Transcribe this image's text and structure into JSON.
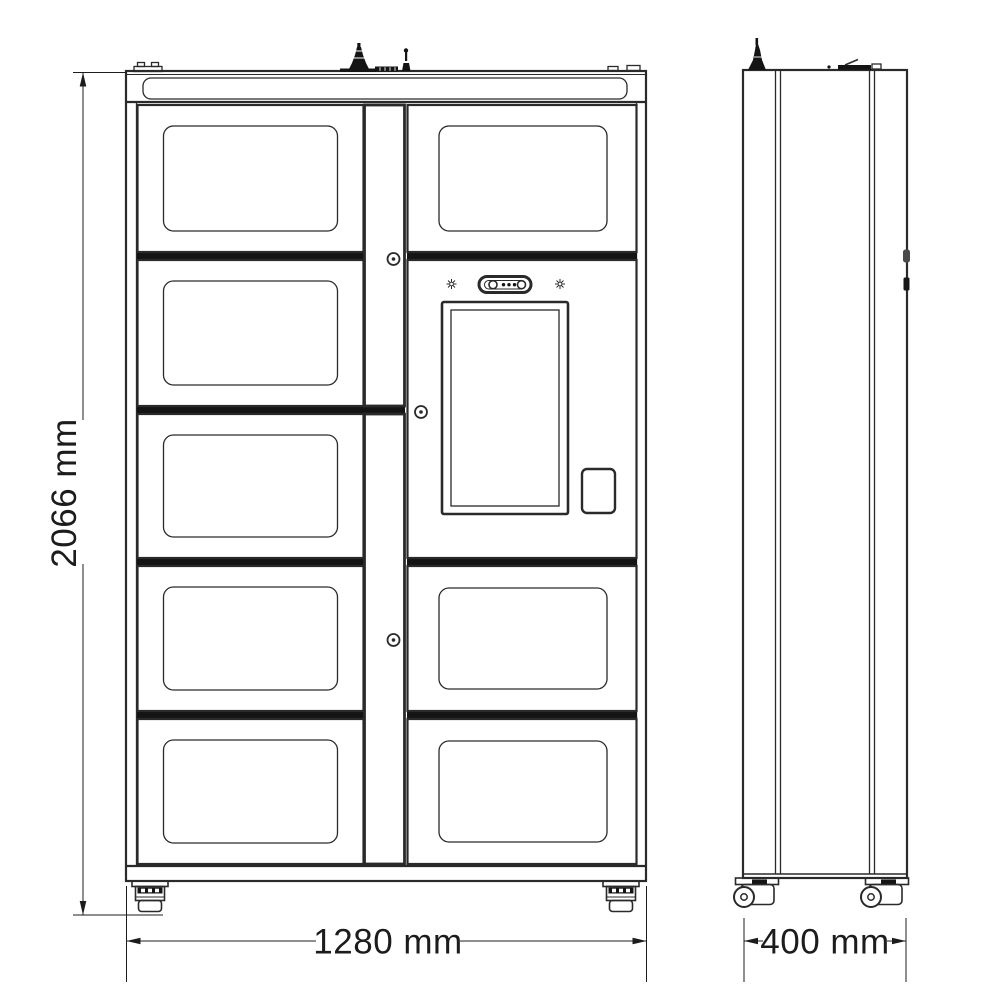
{
  "page": {
    "title": "Smart locker cabinet technical drawing",
    "background": "#ffffff"
  },
  "colors": {
    "line": "#2a2a2a",
    "band": "#141414",
    "text": "#1c1c1c"
  },
  "dimensions": {
    "height": {
      "label": "2066 mm"
    },
    "width": {
      "label": "1280 mm"
    },
    "depth": {
      "label": "400 mm"
    }
  },
  "views": {
    "front": {
      "name": "front-view",
      "left_column_doors": 5,
      "right_column_doors": 3,
      "locks": 3
    },
    "side": {
      "name": "side-view"
    }
  }
}
